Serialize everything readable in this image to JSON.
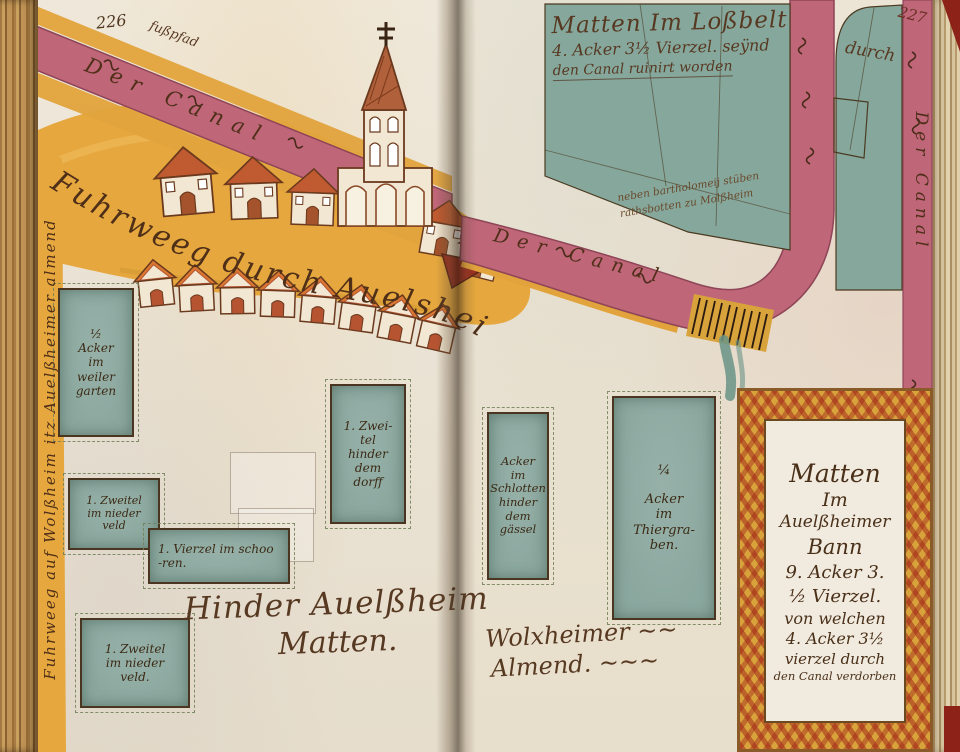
{
  "page": {
    "left_number": "226",
    "right_number": "227"
  },
  "canal": {
    "label_top_left": "Der Canal",
    "label_middle": "Der Canal",
    "label_right_edge": "Der Canal",
    "footpath": "fußpfad"
  },
  "roads": {
    "main": "Fuhrweeg durch Auelsheim",
    "left_edge": "Fuhrweeg auf Wolßheim itz Auelßheimer almend"
  },
  "fields": {
    "lossbelt": {
      "line1": "Matten Im Loßbelt",
      "line2": "4. Acker 3½ Vierzel. seÿnd",
      "line3": "den Canal ruinirt worden",
      "durch": "durch"
    },
    "note": {
      "line1": "neben bartholomeij stüben",
      "line2": "rathsbotten zu Molßheim"
    },
    "hinder": {
      "line1": "Hinder Auelßheim",
      "line2": "Matten."
    },
    "wolxheimer": {
      "line1": "Wolxheimer ~~",
      "line2": "Almend. ~~~"
    },
    "matten_frame": {
      "lines": [
        "Matten",
        "Im",
        "Auelßheimer",
        "Bann",
        "9. Acker 3.",
        "½ Vierzel.",
        "von welchen",
        "4. Acker 3½",
        "vierzel durch",
        "den Canal verdorben"
      ]
    }
  },
  "plots": [
    {
      "name": "weiler-garten",
      "lines": [
        "½",
        "Acker",
        "im",
        "weiler",
        "garten"
      ]
    },
    {
      "name": "niederveld-a",
      "lines": [
        "1. Zweitel",
        "im nieder",
        "veld"
      ]
    },
    {
      "name": "schooren",
      "lines": [
        "1. Vierzel im schoo",
        "-ren."
      ]
    },
    {
      "name": "niederveld-b",
      "lines": [
        "1. Zweitel",
        "im nieder",
        "veld."
      ]
    },
    {
      "name": "hinder-dem-dorff",
      "lines": [
        "1. Zwei-",
        "tel",
        "hinder",
        "dem",
        "dorff"
      ]
    },
    {
      "name": "schlotten-gaessel",
      "lines": [
        "Acker",
        "im",
        "Schlotten",
        "hinder",
        "dem",
        "gässel"
      ]
    },
    {
      "name": "thiergruben",
      "lines": [
        "¼",
        "Acker",
        "im",
        "Thiergra-",
        "ben."
      ]
    }
  ],
  "colors": {
    "canal_pink": "#bf6679",
    "canal_edge": "#8e4557",
    "road_yellow": "#e4a53d",
    "plot_green": "#8ba89f",
    "field_green": "#86a79c",
    "ink_brown": "#573922",
    "roof_red": "#b65432",
    "gable_orange": "#d97732"
  }
}
